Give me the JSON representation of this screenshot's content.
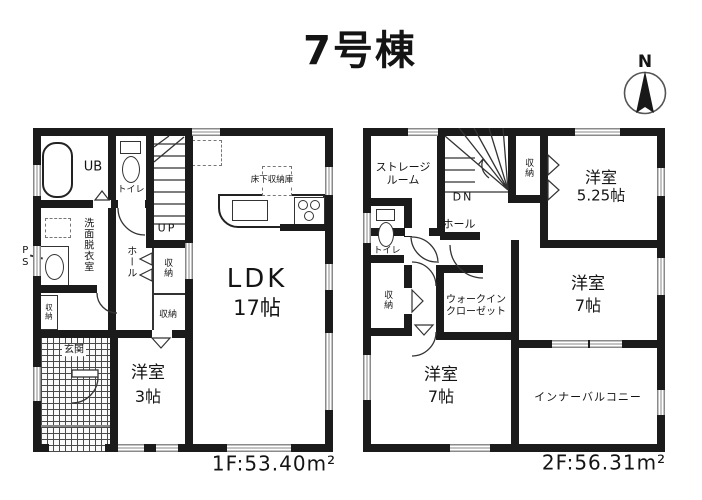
{
  "title": "7号棟",
  "compass": {
    "n": "N"
  },
  "colors": {
    "wall": "#1b1b1b",
    "text": "#141414",
    "window_line": "#8a8a8a",
    "tile_line": "#4a4a4a"
  },
  "floor1": {
    "area": "1F:53.40m²",
    "labels": {
      "ub": "UB",
      "toilet": "トイレ",
      "up": "UP",
      "washroom": "洗面脱衣室",
      "ps": "PS",
      "hall": "ホール",
      "closet_hall": "収納",
      "closet_room3": "収納",
      "closet_mini": "収納",
      "genkan": "玄関",
      "underfloor": "床下収納庫",
      "ldk": "LDK",
      "ldk_size": "17帖",
      "bedroom3": "洋室",
      "bedroom3_size": "3帖"
    }
  },
  "floor2": {
    "area": "2F:56.31m²",
    "labels": {
      "storage_1": "ストレージ",
      "storage_2": "ルーム",
      "dn": "DN",
      "closet_stairs": "収納",
      "bedroom525": "洋室",
      "bedroom525_size": "5.25帖",
      "toilet": "トイレ",
      "hall": "ホール",
      "closet_hall": "収納",
      "wic_1": "ウォークイン",
      "wic_2": "クローゼット",
      "bedroom7e": "洋室",
      "bedroom7e_size": "7帖",
      "bedroom7s": "洋室",
      "bedroom7s_size": "7帖",
      "balcony": "インナーバルコニー"
    }
  }
}
